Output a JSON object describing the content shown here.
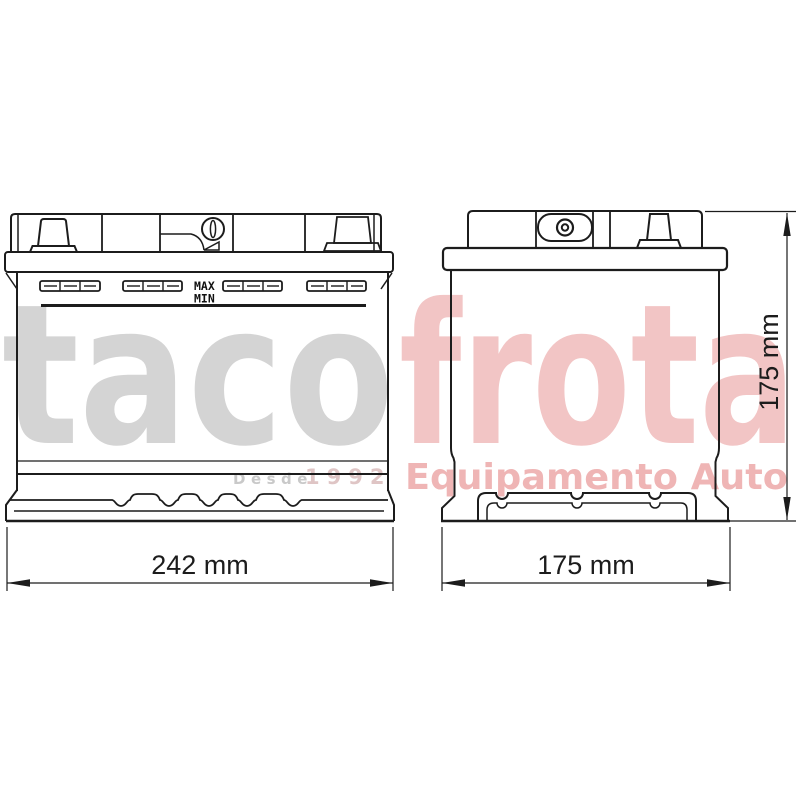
{
  "watermark": {
    "brand": {
      "part1": "taco",
      "part2": "frota",
      "part1_color": "#d4d4d4",
      "part2_color": "#f2c5c5"
    },
    "tagline": {
      "prefix": "Desde",
      "year": "1992",
      "prefix_color": "#c9c9c9",
      "year_color": "#dfc5c5"
    },
    "subtitle": {
      "text": "Equipamento Auto",
      "color": "#efb5b5"
    }
  },
  "diagram": {
    "line_color": "#1c1c1c",
    "front_view": {
      "positive_terminal": {
        "label": "+",
        "color": "#e12f2f"
      },
      "levels": {
        "max": "MAX",
        "min": "MIN"
      },
      "width_dimension": "242 mm"
    },
    "side_view": {
      "width_dimension": "175 mm",
      "height_dimension": "175 mm"
    }
  }
}
